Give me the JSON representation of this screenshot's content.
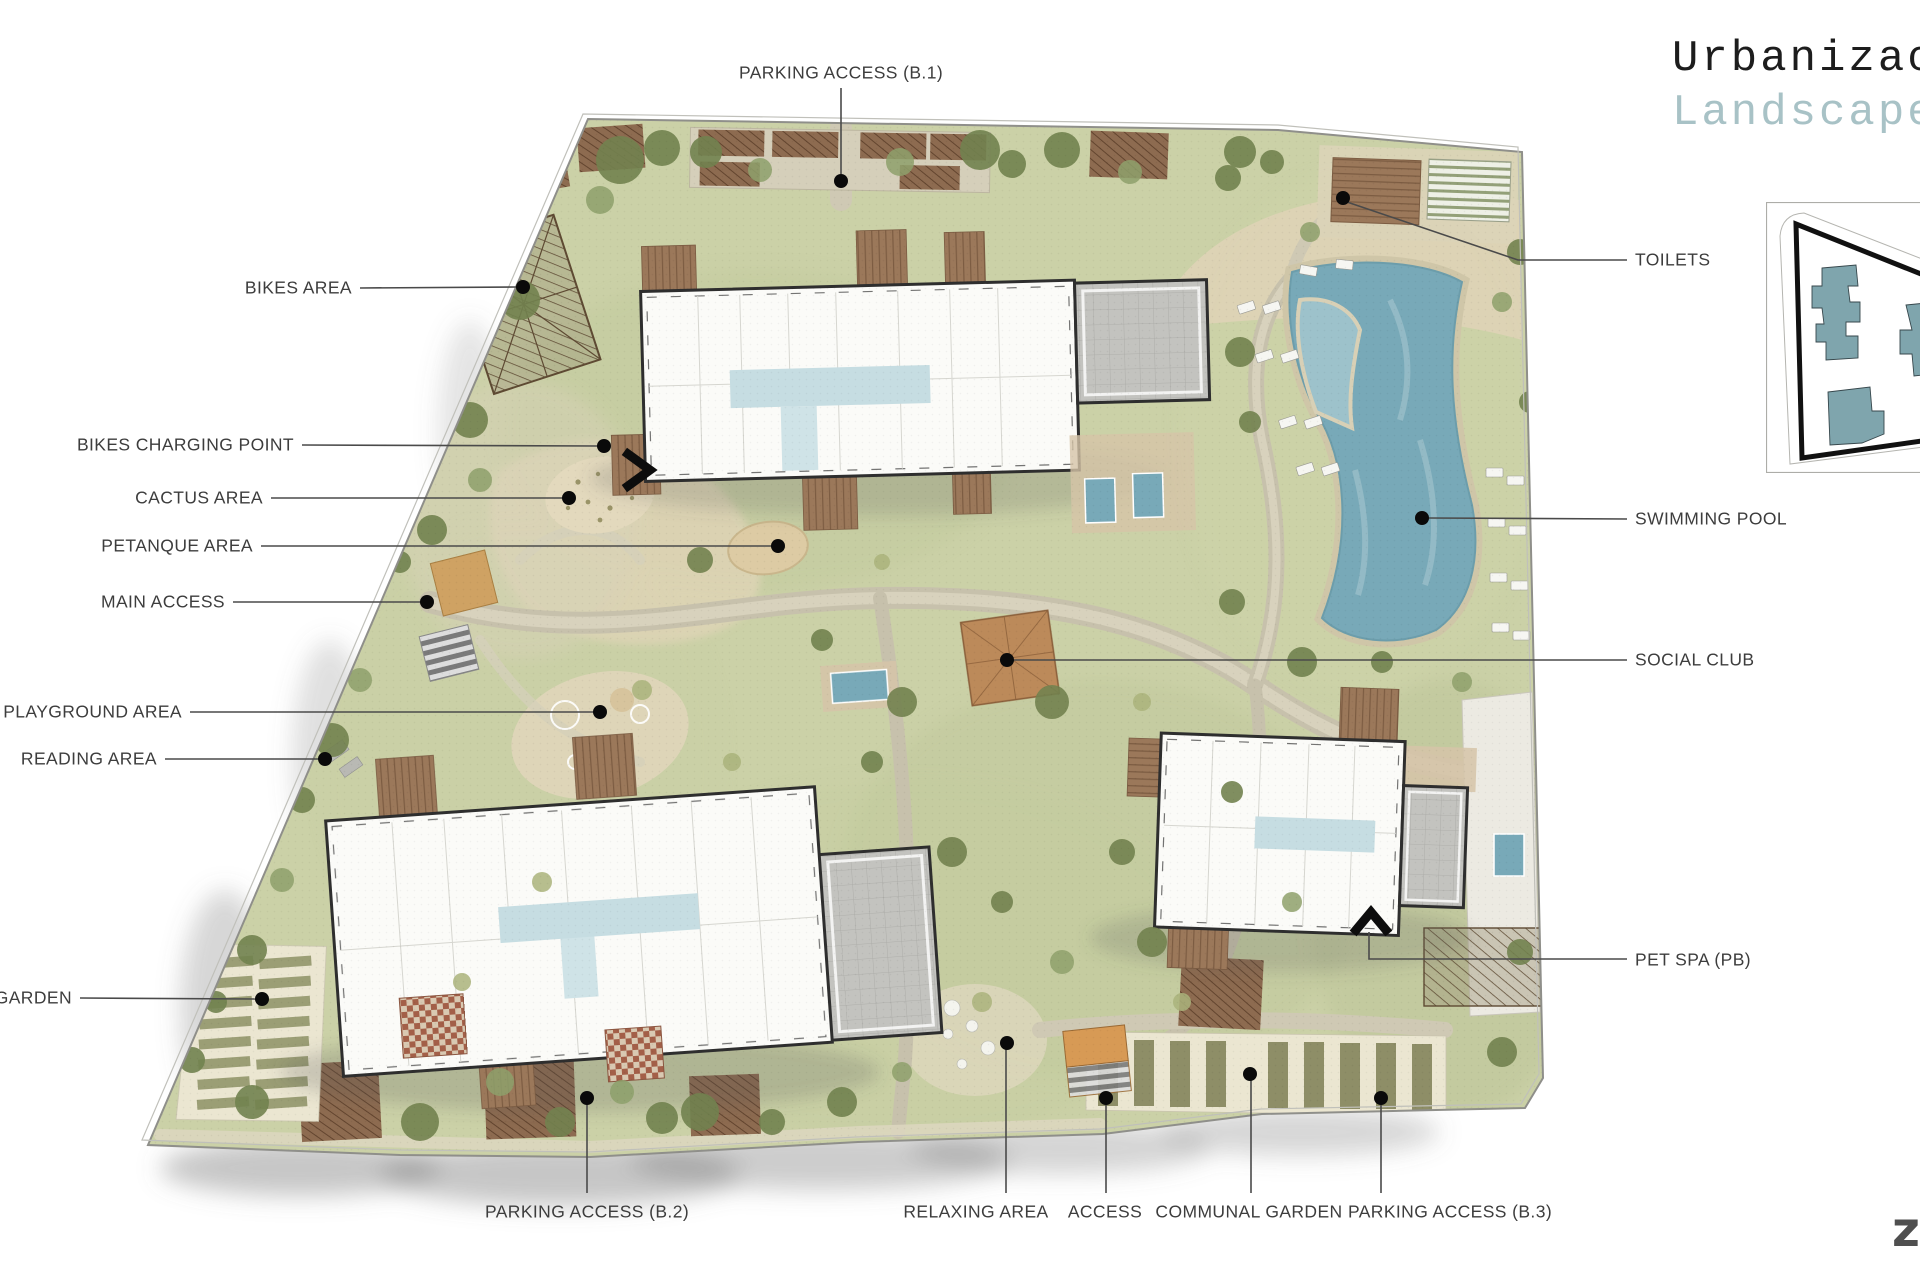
{
  "title": {
    "line1": "Urbanizac",
    "line2": "Landscape"
  },
  "footer_logo": "z",
  "palette": {
    "lawn": "#cbd1a7",
    "lawn_dark": "#9aa87c",
    "tree": "#72824f",
    "sand": "#ddd3b2",
    "path": "#c7c1ac",
    "pool": "#78a9b8",
    "building": "#fbfbf8",
    "building_outline": "#2e2e2e",
    "roof": "#c3c3bf",
    "deck": "#9b785a",
    "terrace_checker": "#a35f48",
    "hedge": "#8d6b50",
    "accent_title": "#a8c2c6",
    "inset_building": "#7fa5ad",
    "label": "#3d3d3d"
  },
  "callouts": [
    {
      "id": "parking-access-b1",
      "label": "PARKING ACCESS (B.1)",
      "align": "center",
      "tx": 841,
      "ty": 73,
      "line": [
        [
          841,
          88
        ],
        [
          841,
          174
        ]
      ],
      "dot": [
        841,
        181
      ]
    },
    {
      "id": "bikes-area",
      "label": "BIKES AREA",
      "align": "right",
      "tx": 352,
      "ty": 288,
      "line": [
        [
          360,
          288
        ],
        [
          517,
          287
        ]
      ],
      "dot": [
        523,
        287
      ]
    },
    {
      "id": "bikes-charging-point",
      "label": "BIKES CHARGING POINT",
      "align": "right",
      "tx": 294,
      "ty": 445,
      "line": [
        [
          302,
          445
        ],
        [
          598,
          446
        ]
      ],
      "dot": [
        604,
        446
      ]
    },
    {
      "id": "cactus-area",
      "label": "CACTUS AREA",
      "align": "right",
      "tx": 263,
      "ty": 498,
      "line": [
        [
          271,
          498
        ],
        [
          563,
          498
        ]
      ],
      "dot": [
        569,
        498
      ]
    },
    {
      "id": "petanque-area",
      "label": "PETANQUE AREA",
      "align": "right",
      "tx": 253,
      "ty": 546,
      "line": [
        [
          261,
          546
        ],
        [
          772,
          546
        ]
      ],
      "dot": [
        778,
        546
      ]
    },
    {
      "id": "main-access",
      "label": "MAIN ACCESS",
      "align": "right",
      "tx": 225,
      "ty": 602,
      "line": [
        [
          233,
          602
        ],
        [
          421,
          602
        ]
      ],
      "dot": [
        427,
        602
      ]
    },
    {
      "id": "playground-area",
      "label": "PLAYGROUND AREA",
      "align": "right",
      "tx": 182,
      "ty": 712,
      "line": [
        [
          190,
          712
        ],
        [
          594,
          712
        ]
      ],
      "dot": [
        600,
        712
      ]
    },
    {
      "id": "reading-area",
      "label": "READING AREA",
      "align": "right",
      "tx": 157,
      "ty": 759,
      "line": [
        [
          165,
          759
        ],
        [
          319,
          759
        ]
      ],
      "dot": [
        325,
        759
      ]
    },
    {
      "id": "communal-garden-left",
      "label": "L GARDEN",
      "align": "right",
      "tx": 72,
      "ty": 998,
      "line": [
        [
          80,
          998
        ],
        [
          256,
          999
        ]
      ],
      "dot": [
        262,
        999
      ]
    },
    {
      "id": "parking-access-b2",
      "label": "PARKING ACCESS (B.2)",
      "align": "center",
      "tx": 587,
      "ty": 1212,
      "line": [
        [
          587,
          1193
        ],
        [
          587,
          1104
        ]
      ],
      "dot": [
        587,
        1098
      ]
    },
    {
      "id": "relaxing-area",
      "label": "RELAXING AREA",
      "align": "center",
      "tx": 976,
      "ty": 1212,
      "line": [
        [
          1006,
          1193
        ],
        [
          1006,
          1049
        ]
      ],
      "dot": [
        1007,
        1043
      ]
    },
    {
      "id": "access",
      "label": "ACCESS",
      "align": "center",
      "tx": 1105,
      "ty": 1212,
      "line": [
        [
          1106,
          1193
        ],
        [
          1106,
          1104
        ]
      ],
      "dot": [
        1106,
        1098
      ]
    },
    {
      "id": "communal-garden",
      "label": "COMMUNAL GARDEN",
      "align": "center",
      "tx": 1249,
      "ty": 1212,
      "line": [
        [
          1251,
          1193
        ],
        [
          1251,
          1080
        ]
      ],
      "dot": [
        1250,
        1074
      ]
    },
    {
      "id": "parking-access-b3",
      "label": "PARKING ACCESS (B.3)",
      "align": "center",
      "tx": 1450,
      "ty": 1212,
      "line": [
        [
          1381,
          1193
        ],
        [
          1381,
          1104
        ]
      ],
      "dot": [
        1381,
        1098
      ]
    },
    {
      "id": "toilets",
      "label": "TOILETS",
      "align": "left",
      "tx": 1635,
      "ty": 260,
      "line": [
        [
          1627,
          260
        ],
        [
          1518,
          260
        ],
        [
          1347,
          202
        ]
      ],
      "dot": [
        1343,
        198
      ]
    },
    {
      "id": "swimming-pool",
      "label": "SWIMMING POOL",
      "align": "left",
      "tx": 1635,
      "ty": 519,
      "line": [
        [
          1627,
          519
        ],
        [
          1428,
          518
        ]
      ],
      "dot": [
        1422,
        518
      ]
    },
    {
      "id": "social-club",
      "label": "SOCIAL CLUB",
      "align": "left",
      "tx": 1635,
      "ty": 660,
      "line": [
        [
          1627,
          660
        ],
        [
          1013,
          660
        ]
      ],
      "dot": [
        1007,
        660
      ]
    },
    {
      "id": "pet-spa-pb",
      "label": "PET SPA (PB)",
      "align": "left",
      "tx": 1635,
      "ty": 960,
      "line": [
        [
          1627,
          959
        ],
        [
          1369,
          959
        ],
        [
          1369,
          932
        ]
      ],
      "dot": null
    }
  ]
}
